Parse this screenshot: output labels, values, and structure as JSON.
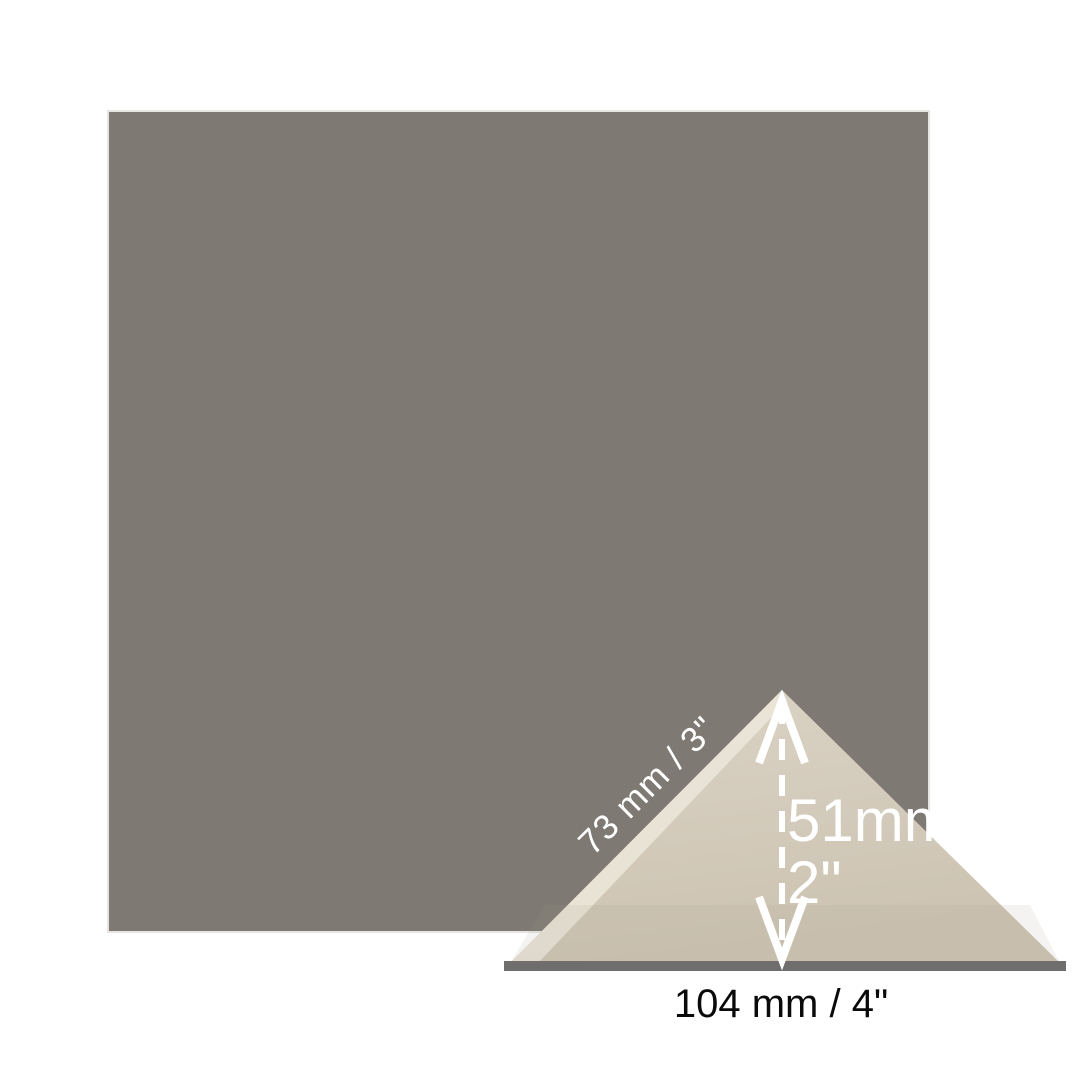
{
  "swatch": {
    "color": "#7E7A73",
    "border_color": "#E6E5E2"
  },
  "tile": {
    "fill_top": "#DBD3C5",
    "fill_bottom": "#CCC3B2",
    "edge_highlight": "#EBE5D9",
    "base_shade": "#A89D89",
    "base_bar_color": "#6F6E6C"
  },
  "annotations": {
    "side_label": "73 mm / 3\"",
    "height_label_mm": "51mm",
    "height_label_in": "2\"",
    "base_label": "104 mm / 4\"",
    "arrow_color": "#FFFFFF",
    "base_label_color": "#0A0A0A"
  }
}
